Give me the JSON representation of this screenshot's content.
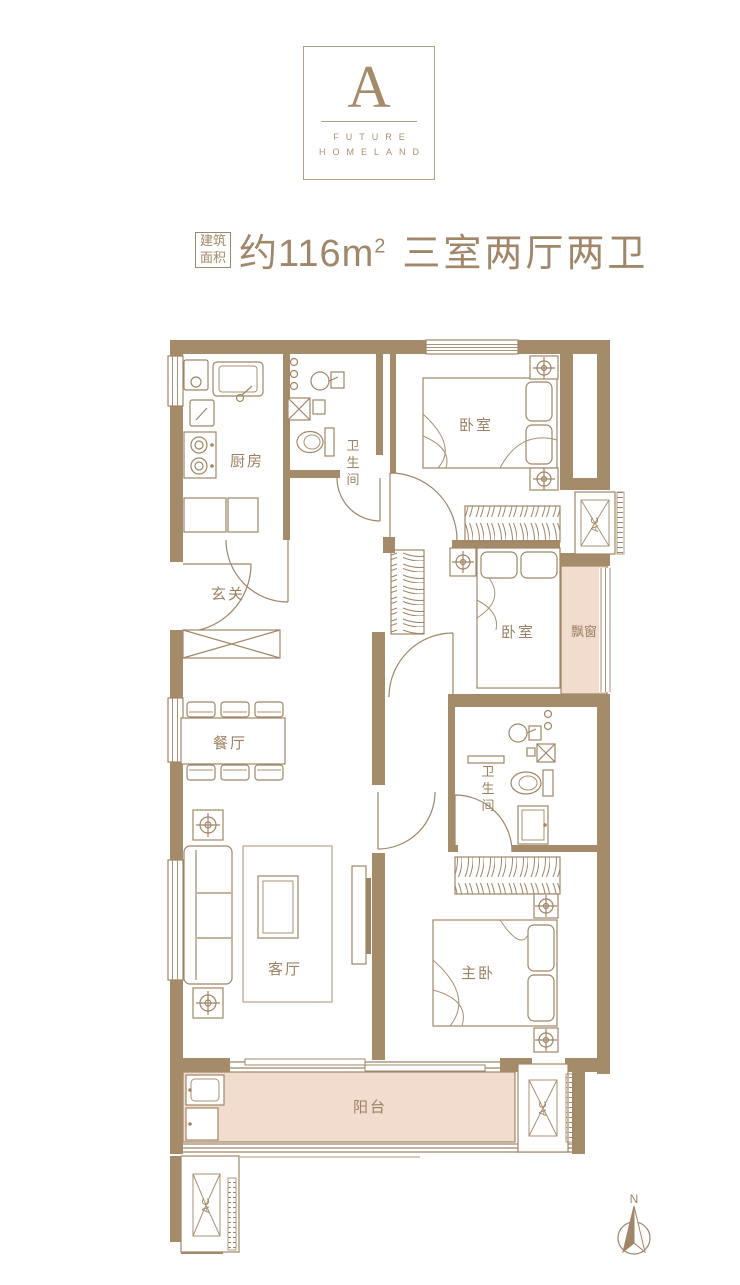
{
  "logo": {
    "letter": "A",
    "word1": "FUTURE",
    "word2": "HOMELAND"
  },
  "title": {
    "badge_line1": "建筑",
    "badge_line2": "面积",
    "area": "约116m",
    "area_exponent": "2",
    "layout": "三室两厅两卫"
  },
  "plan": {
    "labels": {
      "kitchen": "厨房",
      "bedroom1": "卧室",
      "foyer": "玄关",
      "bedroom2": "卧室",
      "bay_window": "飘窗",
      "dining": "餐厅",
      "living": "客厅",
      "master_bedroom": "主卧",
      "balcony": "阳台"
    },
    "labels_vertical": {
      "bath1": [
        "卫",
        "生",
        "间"
      ],
      "bath2": [
        "卫",
        "生",
        "间"
      ]
    },
    "ac_label": "AC",
    "compass": "N",
    "colors": {
      "wall": "#a48b6a",
      "line": "#a08568",
      "area_fill": "#f1dccd",
      "label_text": "#9c8264",
      "title_text": "#a1876a"
    }
  }
}
